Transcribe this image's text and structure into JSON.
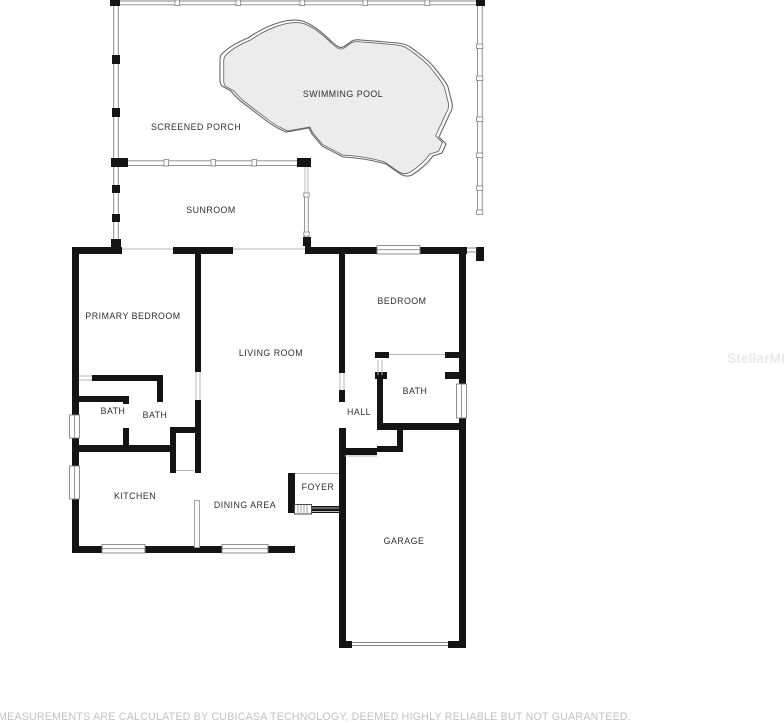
{
  "plan": {
    "footer": "MEASUREMENTS ARE CALCULATED BY CUBICASA TECHNOLOGY, DEEMED HIGHLY RELIABLE BUT NOT GUARANTEED.",
    "watermark": "StellarMLS",
    "rooms": [
      {
        "label": "SWIMMING POOL",
        "x": 343,
        "y": 97
      },
      {
        "label": "SCREENED PORCH",
        "x": 196,
        "y": 130
      },
      {
        "label": "SUNROOM",
        "x": 211,
        "y": 213
      },
      {
        "label": "PRIMARY BEDROOM",
        "x": 133,
        "y": 319
      },
      {
        "label": "LIVING ROOM",
        "x": 271,
        "y": 356
      },
      {
        "label": "BEDROOM",
        "x": 402,
        "y": 304
      },
      {
        "label": "BATH",
        "x": 415,
        "y": 394
      },
      {
        "label": "HALL",
        "x": 359,
        "y": 415
      },
      {
        "label": "BATH",
        "x": 113,
        "y": 414
      },
      {
        "label": "BATH",
        "x": 155,
        "y": 418
      },
      {
        "label": "KITCHEN",
        "x": 135,
        "y": 499
      },
      {
        "label": "DINING AREA",
        "x": 245,
        "y": 508
      },
      {
        "label": "FOYER",
        "x": 318,
        "y": 490
      },
      {
        "label": "GARAGE",
        "x": 404,
        "y": 544
      }
    ],
    "colors": {
      "wall": "#141414",
      "pool_fill": "#ececec",
      "pool_stroke": "#666666",
      "window_stroke": "#828282",
      "thin_line": "#b5b5b5",
      "label": "#2e2e2e",
      "footer": "#c2c2c2",
      "watermark": "#e9e9e9"
    }
  }
}
